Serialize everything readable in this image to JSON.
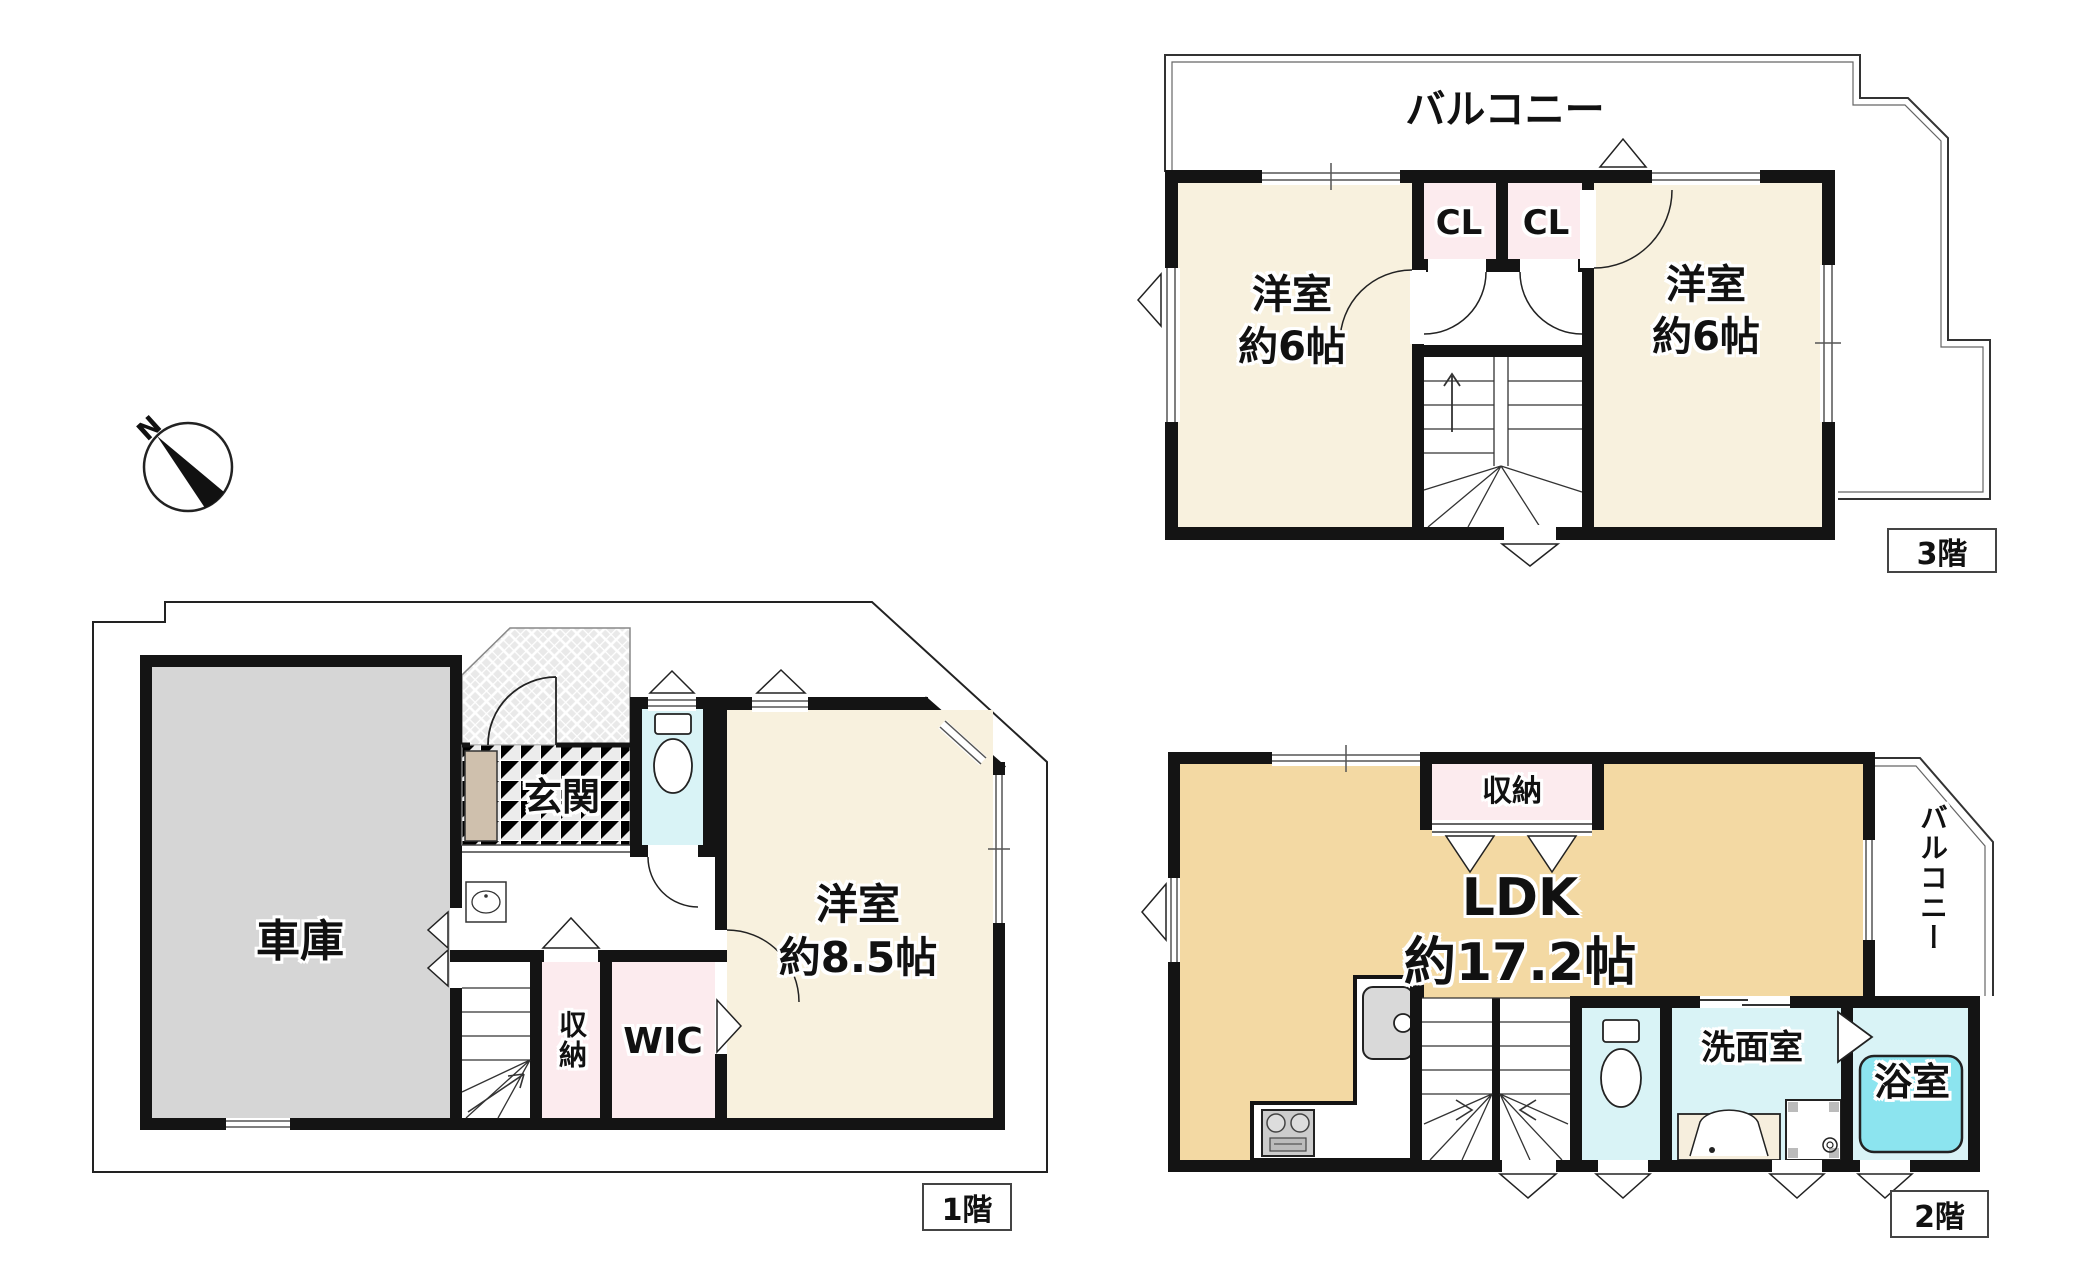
{
  "compass": {
    "north_label": "N"
  },
  "palette": {
    "wall": "#141414",
    "thin_line": "#333333",
    "cream_room": "#f8f1de",
    "tan_ldk": "#f3d9a3",
    "pink_storage": "#fcebee",
    "cyan_wet": "#d9f3f6",
    "tub_cyan": "#8ce4ef",
    "garage_gray": "#d6d6d6",
    "cabinet_beige": "#cfc0ad",
    "tile_gray": "#ececec"
  },
  "floor1": {
    "tag": "1階",
    "garage": "車庫",
    "entrance": "玄関",
    "western_room": "洋室",
    "western_room_size": "約8.5帖",
    "storage": "収納",
    "wic": "WIC"
  },
  "floor2": {
    "tag": "2階",
    "ldk": "LDK",
    "ldk_size": "約17.2帖",
    "storage": "収納",
    "washroom": "洗面室",
    "bathroom": "浴室",
    "balcony": "バルコニー"
  },
  "floor3": {
    "tag": "3階",
    "balcony": "バルコニー",
    "left_room": "洋室",
    "left_room_size": "約6帖",
    "right_room": "洋室",
    "right_room_size": "約6帖",
    "closet_a": "CL",
    "closet_b": "CL"
  }
}
